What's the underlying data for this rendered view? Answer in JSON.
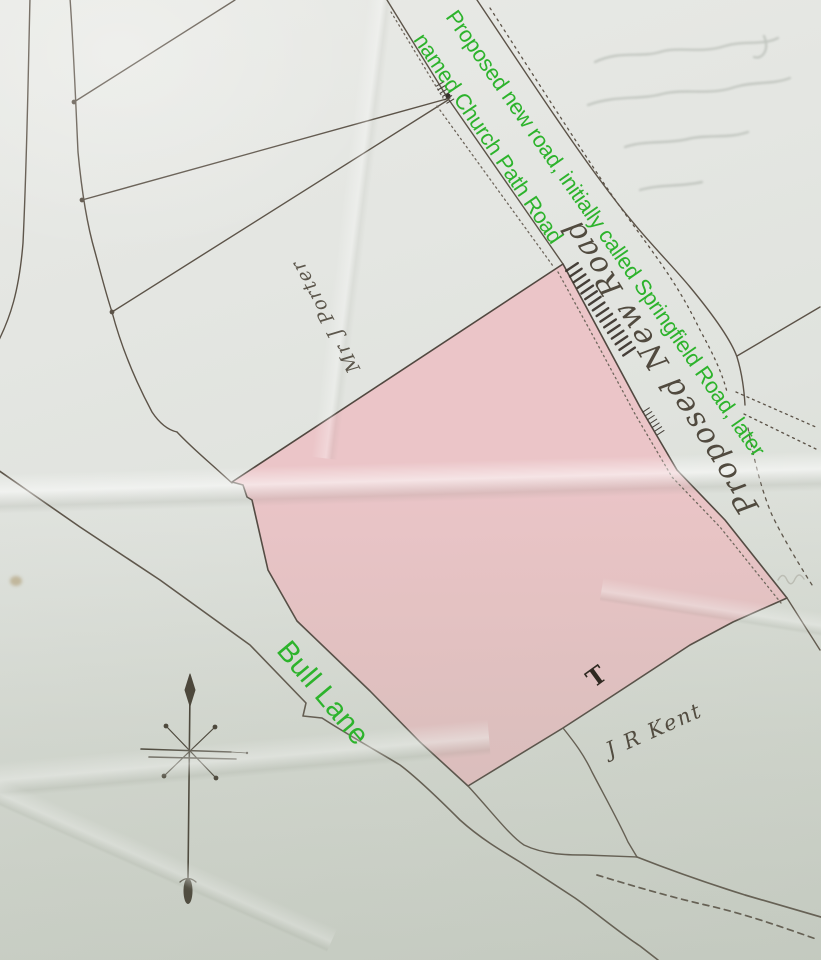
{
  "document": {
    "kind": "photograph of a hand-drawn land plan",
    "parcel_shading": "pink"
  },
  "colors": {
    "annotation_green": "#2db32c",
    "parcel_pink": "#ecc2c5",
    "ink": "#564e43",
    "paper": "#e2e4df"
  },
  "labels": {
    "road_note_line1": "Proposed new road, initially called Springfield Road, later",
    "road_note_line2": "named Church Path Road",
    "bull_lane": "Bull Lane",
    "proposed_new_road": "Proposed New Road",
    "owner_upper": "Mr J Porter",
    "owner_lower": "J R Kent",
    "boundary_mark": "T"
  },
  "icons": {
    "compass_rose": "north-arrow with star cross"
  }
}
